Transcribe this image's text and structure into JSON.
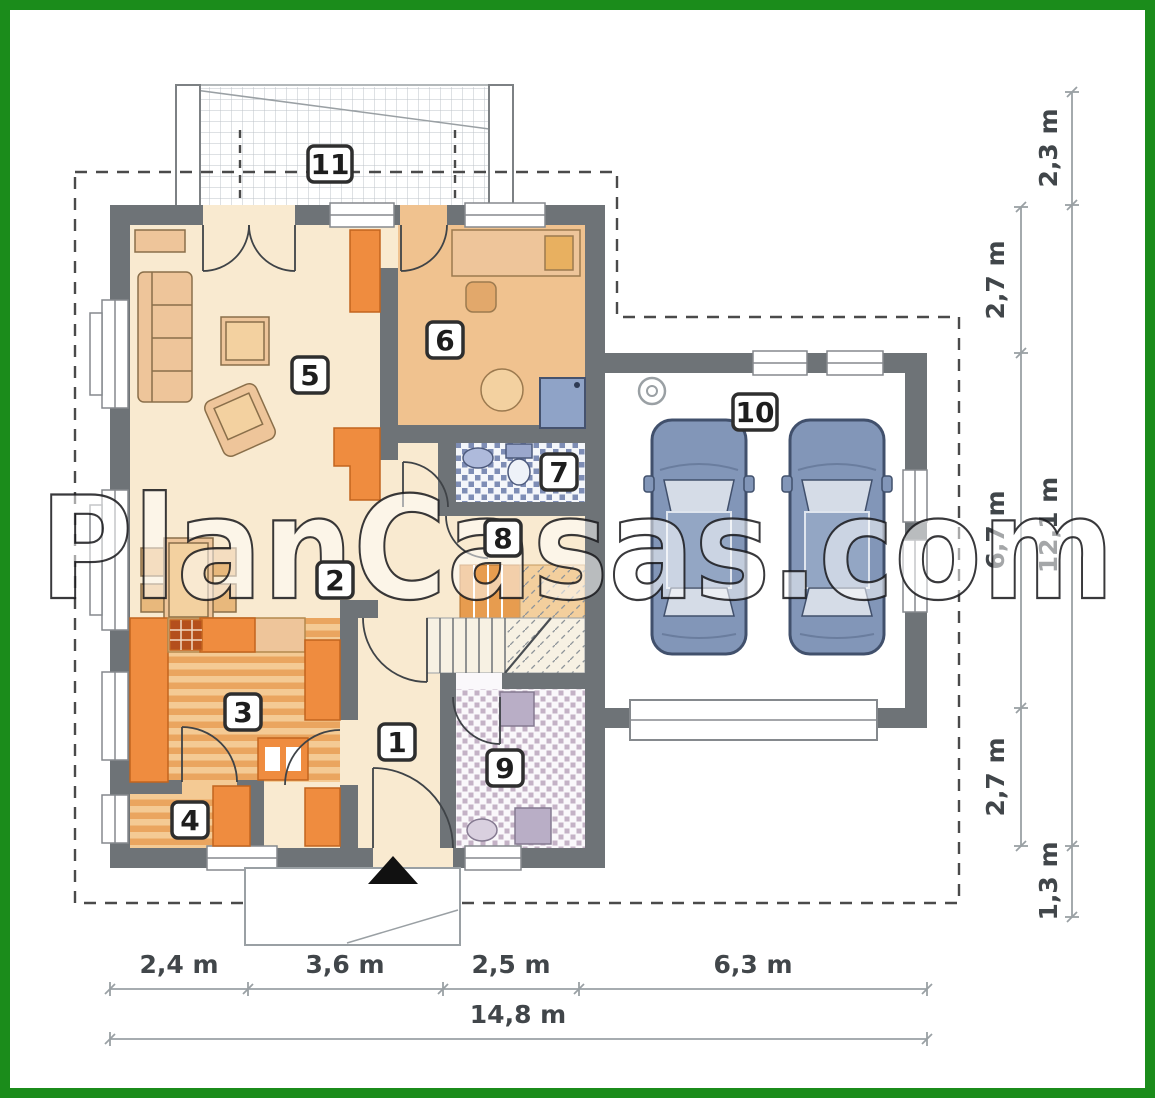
{
  "watermark": "PlanCasas.com",
  "room_labels": [
    "1",
    "2",
    "3",
    "4",
    "5",
    "6",
    "7",
    "8",
    "9",
    "10",
    "11"
  ],
  "dims": {
    "bottom": [
      "2,4 m",
      "3,6 m",
      "2,5 m",
      "6,3 m"
    ],
    "bottom_total": "14,8 m",
    "right_inner": [
      "2,7 m",
      "6,7 m",
      "2,7 m"
    ],
    "right_outer": [
      "2,3 m",
      "12,1 m",
      "1,3 m"
    ]
  },
  "colors": {
    "frame_green": "#1b8c1b",
    "wall_gray": "#6e7377",
    "floor_cream": "#f9ead0",
    "floor_tan": "#f0c28f",
    "accent_orange": "#ef8c3f",
    "furniture_tan": "#eec59a",
    "tile_blue": "#7e8db5",
    "tile_mauve": "#c4b2c6",
    "car_blue": "#8296b8"
  }
}
